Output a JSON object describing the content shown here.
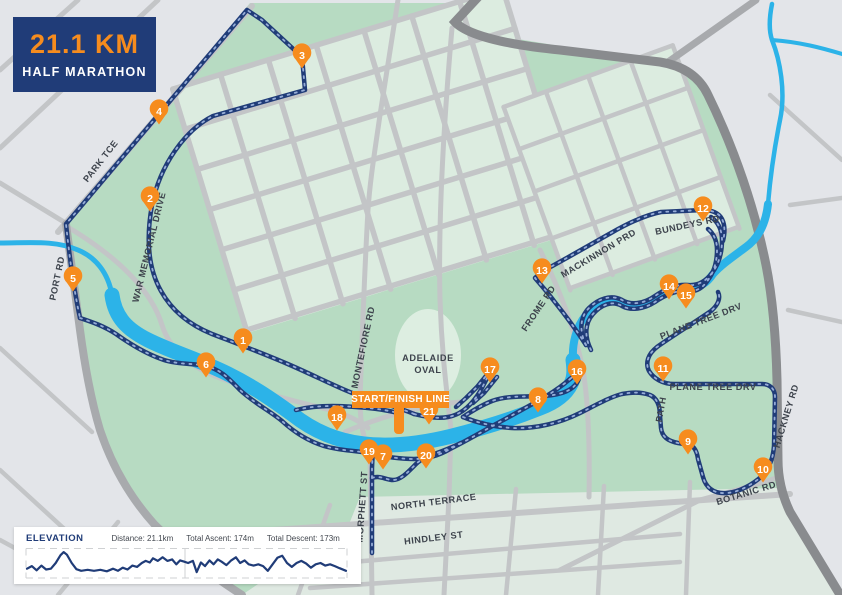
{
  "title_card": {
    "distance": "21.1 KM",
    "event": "HALF MARATHON"
  },
  "start_finish": {
    "label": "START/FINISH LINE"
  },
  "oval": {
    "line1": "ADELAIDE",
    "line2": "OVAL"
  },
  "markers": [
    {
      "n": "1",
      "x": 243,
      "y": 340
    },
    {
      "n": "2",
      "x": 150,
      "y": 198
    },
    {
      "n": "3",
      "x": 302,
      "y": 55
    },
    {
      "n": "4",
      "x": 159,
      "y": 111
    },
    {
      "n": "5",
      "x": 73,
      "y": 278
    },
    {
      "n": "6",
      "x": 206,
      "y": 364
    },
    {
      "n": "7",
      "x": 383,
      "y": 456
    },
    {
      "n": "8",
      "x": 538,
      "y": 399
    },
    {
      "n": "9",
      "x": 688,
      "y": 441
    },
    {
      "n": "10",
      "x": 763,
      "y": 469
    },
    {
      "n": "11",
      "x": 663,
      "y": 368
    },
    {
      "n": "12",
      "x": 703,
      "y": 208
    },
    {
      "n": "13",
      "x": 542,
      "y": 270
    },
    {
      "n": "14",
      "x": 669,
      "y": 286
    },
    {
      "n": "15",
      "x": 686,
      "y": 295
    },
    {
      "n": "16",
      "x": 577,
      "y": 371
    },
    {
      "n": "17",
      "x": 490,
      "y": 369
    },
    {
      "n": "18",
      "x": 337,
      "y": 417
    },
    {
      "n": "19",
      "x": 369,
      "y": 451
    },
    {
      "n": "20",
      "x": 426,
      "y": 455
    },
    {
      "n": "21",
      "x": 429,
      "y": 411
    }
  ],
  "street_labels": [
    {
      "name": "PARK TCE",
      "x": 103,
      "y": 163,
      "rot": -52
    },
    {
      "name": "WAR MEMORIAL DRIVE",
      "x": 152,
      "y": 248,
      "rot": -76
    },
    {
      "name": "PORT RD",
      "x": 60,
      "y": 279,
      "rot": -78
    },
    {
      "name": "MONTEFIORE RD",
      "x": 366,
      "y": 348,
      "rot": -78
    },
    {
      "name": "FROME RD",
      "x": 541,
      "y": 310,
      "rot": -56
    },
    {
      "name": "MACKINNON PRD",
      "x": 600,
      "y": 256,
      "rot": -31
    },
    {
      "name": "BUNDEYS RD",
      "x": 688,
      "y": 228,
      "rot": -12
    },
    {
      "name": "PLANE TREE DRV",
      "x": 702,
      "y": 324,
      "rot": -21
    },
    {
      "name": "PLANE TREE DRV",
      "x": 713,
      "y": 390,
      "rot": 0
    },
    {
      "name": "PATH",
      "x": 664,
      "y": 410,
      "rot": -80
    },
    {
      "name": "HACKNEY RD",
      "x": 789,
      "y": 417,
      "rot": -73
    },
    {
      "name": "BOTANIC RD",
      "x": 747,
      "y": 496,
      "rot": -17
    },
    {
      "name": "NORTH TERRACE",
      "x": 434,
      "y": 505,
      "rot": -7
    },
    {
      "name": "HINDLEY ST",
      "x": 434,
      "y": 541,
      "rot": -7
    },
    {
      "name": "MORPHETT ST",
      "x": 365,
      "y": 507,
      "rot": -86
    }
  ],
  "elevation_panel": {
    "title": "ELEVATION",
    "stats": [
      "Distance: 21.1km",
      "Total Ascent: 174m",
      "Total Descent: 173m"
    ],
    "profile": [
      [
        0,
        0.72
      ],
      [
        0.015,
        0.62
      ],
      [
        0.03,
        0.78
      ],
      [
        0.045,
        0.6
      ],
      [
        0.06,
        0.75
      ],
      [
        0.075,
        0.72
      ],
      [
        0.09,
        0.5
      ],
      [
        0.105,
        0.2
      ],
      [
        0.115,
        0.08
      ],
      [
        0.125,
        0.18
      ],
      [
        0.14,
        0.5
      ],
      [
        0.155,
        0.74
      ],
      [
        0.17,
        0.8
      ],
      [
        0.19,
        0.76
      ],
      [
        0.21,
        0.8
      ],
      [
        0.23,
        0.76
      ],
      [
        0.25,
        0.82
      ],
      [
        0.27,
        0.72
      ],
      [
        0.285,
        0.8
      ],
      [
        0.3,
        0.68
      ],
      [
        0.315,
        0.75
      ],
      [
        0.33,
        0.6
      ],
      [
        0.345,
        0.65
      ],
      [
        0.36,
        0.5
      ],
      [
        0.372,
        0.42
      ],
      [
        0.385,
        0.48
      ],
      [
        0.395,
        0.32
      ],
      [
        0.41,
        0.42
      ],
      [
        0.425,
        0.28
      ],
      [
        0.44,
        0.42
      ],
      [
        0.455,
        0.36
      ],
      [
        0.468,
        0.55
      ],
      [
        0.48,
        0.4
      ],
      [
        0.493,
        0.45
      ],
      [
        0.505,
        0.5
      ],
      [
        0.52,
        0.42
      ],
      [
        0.532,
        0.85
      ],
      [
        0.545,
        0.48
      ],
      [
        0.558,
        0.62
      ],
      [
        0.572,
        0.4
      ],
      [
        0.585,
        0.55
      ],
      [
        0.598,
        0.36
      ],
      [
        0.61,
        0.45
      ],
      [
        0.625,
        0.58
      ],
      [
        0.64,
        0.4
      ],
      [
        0.655,
        0.28
      ],
      [
        0.668,
        0.5
      ],
      [
        0.682,
        0.4
      ],
      [
        0.695,
        0.55
      ],
      [
        0.71,
        0.6
      ],
      [
        0.725,
        0.55
      ],
      [
        0.74,
        0.62
      ],
      [
        0.755,
        0.8
      ],
      [
        0.77,
        0.55
      ],
      [
        0.785,
        0.3
      ],
      [
        0.8,
        0.22
      ],
      [
        0.815,
        0.5
      ],
      [
        0.83,
        0.65
      ],
      [
        0.845,
        0.5
      ],
      [
        0.86,
        0.42
      ],
      [
        0.875,
        0.52
      ],
      [
        0.89,
        0.68
      ],
      [
        0.905,
        0.55
      ],
      [
        0.92,
        0.5
      ],
      [
        0.935,
        0.6
      ],
      [
        0.95,
        0.55
      ],
      [
        0.965,
        0.62
      ],
      [
        0.98,
        0.7
      ],
      [
        1,
        0.8
      ]
    ]
  },
  "colors": {
    "navy": "#203c78",
    "orange": "#f68c1e",
    "river": "#2cb3e8",
    "park": "#b7dbc2",
    "park_block": "#dcece0",
    "city_green": "#dfe9e2",
    "background": "#e3e5e9",
    "road": "#c3c5c7",
    "road_dark": "#898b8e",
    "road_medium": "#a8aaad",
    "label": "#3d434c",
    "route_dash": "#96add8"
  }
}
